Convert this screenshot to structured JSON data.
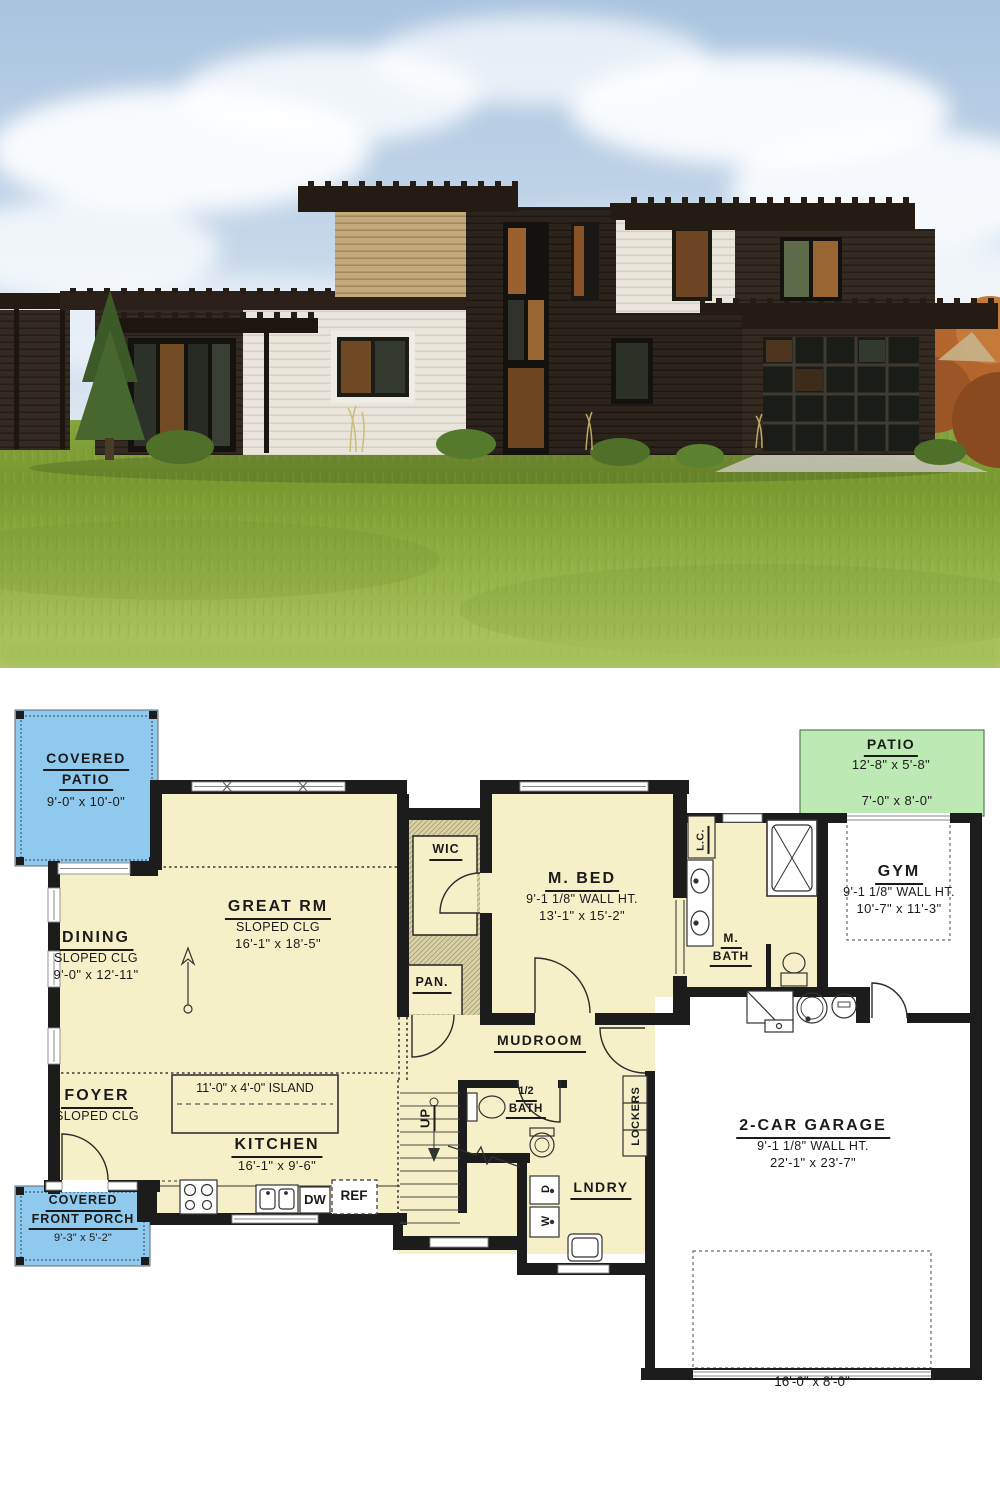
{
  "colors": {
    "wall": "#1c1c1c",
    "room_fill": "#f6f0c8",
    "hatch_fill": "#d9d2a7",
    "patio_blue": "#8fc9ee",
    "patio_green": "#bce9b4",
    "sky": "#a9c4e0",
    "grass": "#8aa83f",
    "siding_dark": "#2e2620",
    "siding_tan": "#c2aa7c",
    "siding_white": "#e9e5da"
  },
  "plan": {
    "covered_patio": {
      "line1": "COVERED",
      "line2": "PATIO",
      "dims": "9'-0\" x 10'-0\""
    },
    "patio": {
      "name": "PATIO",
      "dims": "12'-8\" x 5'-8\"",
      "opening": "7'-0\" x 8'-0\""
    },
    "great_rm": {
      "name": "GREAT RM",
      "ceiling": "SLOPED CLG",
      "dims": "16'-1\" x 18'-5\""
    },
    "dining": {
      "name": "DINING",
      "ceiling": "SLOPED CLG",
      "dims": "9'-0\" x 12'-11\""
    },
    "foyer": {
      "name": "FOYER",
      "ceiling": "SLOPED CLG"
    },
    "wic": {
      "name": "WIC"
    },
    "pantry": {
      "name": "PAN."
    },
    "linen": {
      "name": "L.C."
    },
    "m_bed": {
      "name": "M. BED",
      "wall_ht": "9'-1 1/8\" WALL HT.",
      "dims": "13'-1\" x 15'-2\""
    },
    "m_bath": {
      "line1": "M.",
      "line2": "BATH"
    },
    "gym": {
      "name": "GYM",
      "wall_ht": "9'-1 1/8\" WALL HT.",
      "dims": "10'-7\" x 11'-3\""
    },
    "island": {
      "label": "11'-0\" x 4'-0\" ISLAND"
    },
    "kitchen": {
      "name": "KITCHEN",
      "dims": "16'-1\" x 9'-6\""
    },
    "mudroom": {
      "name": "MUDROOM"
    },
    "half_bath": {
      "line1": "1/2",
      "line2": "BATH"
    },
    "stairs": {
      "label": "UP"
    },
    "lockers": {
      "name": "LOCKERS"
    },
    "laundry": {
      "name": "LNDRY"
    },
    "appliances": {
      "dishwasher": "DW",
      "refrigerator": "REF",
      "washer": "W",
      "dryer": "D"
    },
    "garage": {
      "name": "2-CAR GARAGE",
      "wall_ht": "9'-1 1/8\" WALL HT.",
      "dims": "22'-1\" x 23'-7\"",
      "door_dims": "16'-0\" x 8'-0\""
    },
    "front_porch": {
      "line1": "COVERED",
      "line2": "FRONT PORCH",
      "dims": "9'-3\" x 5'-2\""
    }
  }
}
